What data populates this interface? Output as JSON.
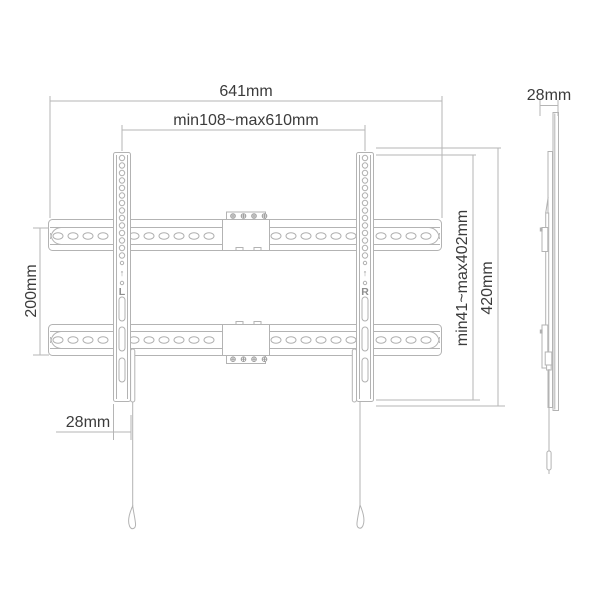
{
  "diagram": {
    "type": "technical-drawing",
    "subject": "fixed TV wall mount bracket, front view and side view with dimension annotations",
    "dimensions": {
      "total_width": "641mm",
      "hole_pattern_width_range": "min108~max610mm",
      "profile_depth": "28mm",
      "rail_vertical_spacing": "200mm",
      "hole_pattern_height_range": "min41~max402mm",
      "total_height": "420mm",
      "arm_width": "28mm"
    },
    "views": {
      "front": {
        "left_arm_marking": {
          "arrow": "↑",
          "label": "L"
        },
        "right_arm_marking": {
          "arrow": "↑",
          "label": "R"
        }
      }
    },
    "colors": {
      "line": "#b3b3b3",
      "dimension_line": "#b5b5b5",
      "text": "#3b3b3b",
      "marking_text": "#8e8e8e",
      "background": "#ffffff"
    }
  }
}
